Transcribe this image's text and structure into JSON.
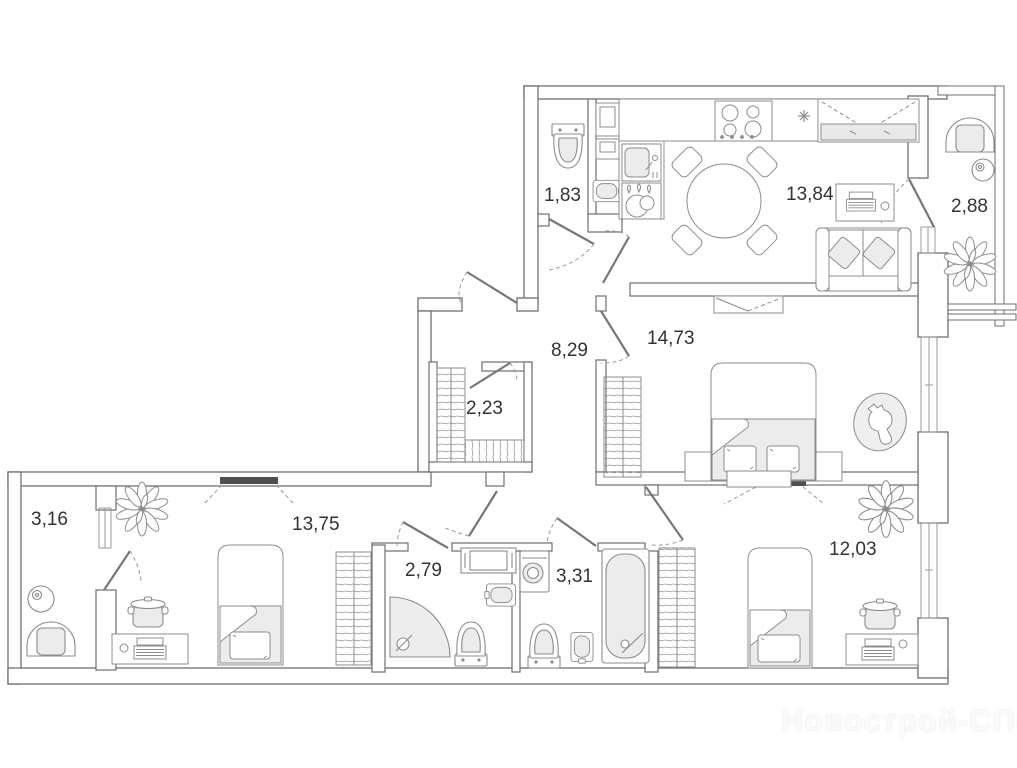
{
  "watermark": "Новострой-СПб",
  "rooms": {
    "wc": {
      "name": "wc",
      "area": "1,83"
    },
    "kitchen_living": {
      "name": "kitchen-living",
      "area": "13,84"
    },
    "balcony_right": {
      "name": "balcony-right",
      "area": "2,88"
    },
    "hall": {
      "name": "hall",
      "area": "8,29"
    },
    "bedroom": {
      "name": "bedroom",
      "area": "14,73"
    },
    "closet": {
      "name": "closet",
      "area": "2,23"
    },
    "balcony_left": {
      "name": "balcony-left",
      "area": "3,16"
    },
    "bedroom_2": {
      "name": "bedroom-2",
      "area": "13,75"
    },
    "shower_room": {
      "name": "shower-room",
      "area": "2,79"
    },
    "bathroom": {
      "name": "bathroom",
      "area": "3,31"
    },
    "bedroom_3": {
      "name": "bedroom-3",
      "area": "12,03"
    }
  },
  "icons": {
    "toilet": "toilet-icon",
    "sink": "sink-icon",
    "bathtub": "bathtub-icon",
    "shower": "corner-shower-icon",
    "washing_machine": "washing-machine-icon",
    "stove": "stove-icon",
    "fridge": "fridge-icon",
    "dining_table": "dining-table-icon",
    "sofa": "sofa-icon",
    "bed_double": "double-bed-icon",
    "bed_single": "single-bed-icon",
    "wardrobe": "wardrobe-icon",
    "plant": "plant-icon",
    "armchair": "armchair-icon",
    "desk_laptop": "desk-laptop-icon",
    "pot": "pot-icon",
    "dog_on_rug": "dog-on-rug-icon"
  },
  "colors": {
    "wall_line": "#6f6f6f",
    "furniture_line": "#8c8c8c",
    "fill_light": "#ececec",
    "window_bar": "#4f4f4f",
    "label_text": "#333333",
    "watermark": "#fafafa"
  }
}
